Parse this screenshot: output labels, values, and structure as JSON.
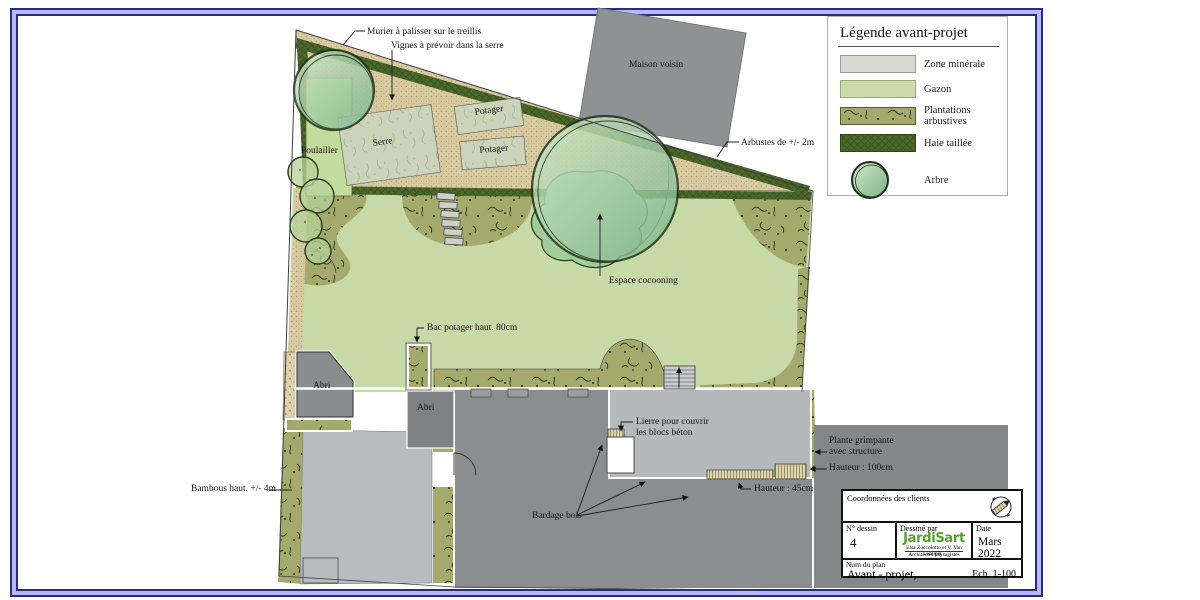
{
  "plan": {
    "labels": {
      "murier": "Murier à palisser sur le treillis",
      "vignes": "Vignes à prévoir dans la serre",
      "maison_voisin": "Maison voisin",
      "arbustes": "Arbustes de +/- 2m",
      "poulailler": "Poulailler",
      "serre": "Serre",
      "potager1": "Potager",
      "potager2": "Potager",
      "espace_cocooning": "Espace cocooning",
      "bac_potager": "Bac potager haut. 80cm",
      "abri1": "Abri",
      "abri2": "Abri",
      "lierre_l1": "Lierre pour couvrir",
      "lierre_l2": "les blocs béton",
      "plante_grimpante_l1": "Plante grimpante",
      "plante_grimpante_l2": "avec structure",
      "hauteur_100": "Hauteur : 100cm",
      "hauteur_45": "Hauteur : 45cm",
      "bardage_bois": "Bardage bois",
      "bambous": "Bambous haut. +/- 4m"
    },
    "colors": {
      "frame": "#2b2b85",
      "frame_band": "#b7baea",
      "lawn": "#c6d9a7",
      "mineral": "#d8cba2",
      "shrub_olive": "#a4a96c",
      "hedge": "#4d682c",
      "tree_light": "#d2e8c6",
      "tree_dark": "#7ab489",
      "building_gray": "#8b8e90",
      "terrace_gray": "#b6b9bc",
      "logo_green": "#53a02e"
    }
  },
  "legend": {
    "title": "Légende avant-projet",
    "items": [
      {
        "label": "Zone minérale",
        "swatch": "mineral"
      },
      {
        "label": "Gazon",
        "swatch": "gazon"
      },
      {
        "label": "Plantations arbustives",
        "swatch": "arbustives"
      },
      {
        "label": "Haie taillée",
        "swatch": "haie"
      },
      {
        "label": "Arbre",
        "swatch": "arbre"
      }
    ]
  },
  "title_block": {
    "clients_label": "Coordonnées des clients",
    "drawing_no_label": "N° dessin",
    "drawing_no": "4",
    "drawn_by_label": "Dessiné par",
    "logo": "JardiSart",
    "architects_l1": "Elsa Zuccolotto et V. Van Lommel -",
    "architects_l2": "Architectes paysagistes",
    "date_label": "Date",
    "date": "Mars 2022",
    "plan_name_label": "Nom du plan",
    "plan_name": "Avant - projet,",
    "scale": "Ech. 1-100"
  }
}
